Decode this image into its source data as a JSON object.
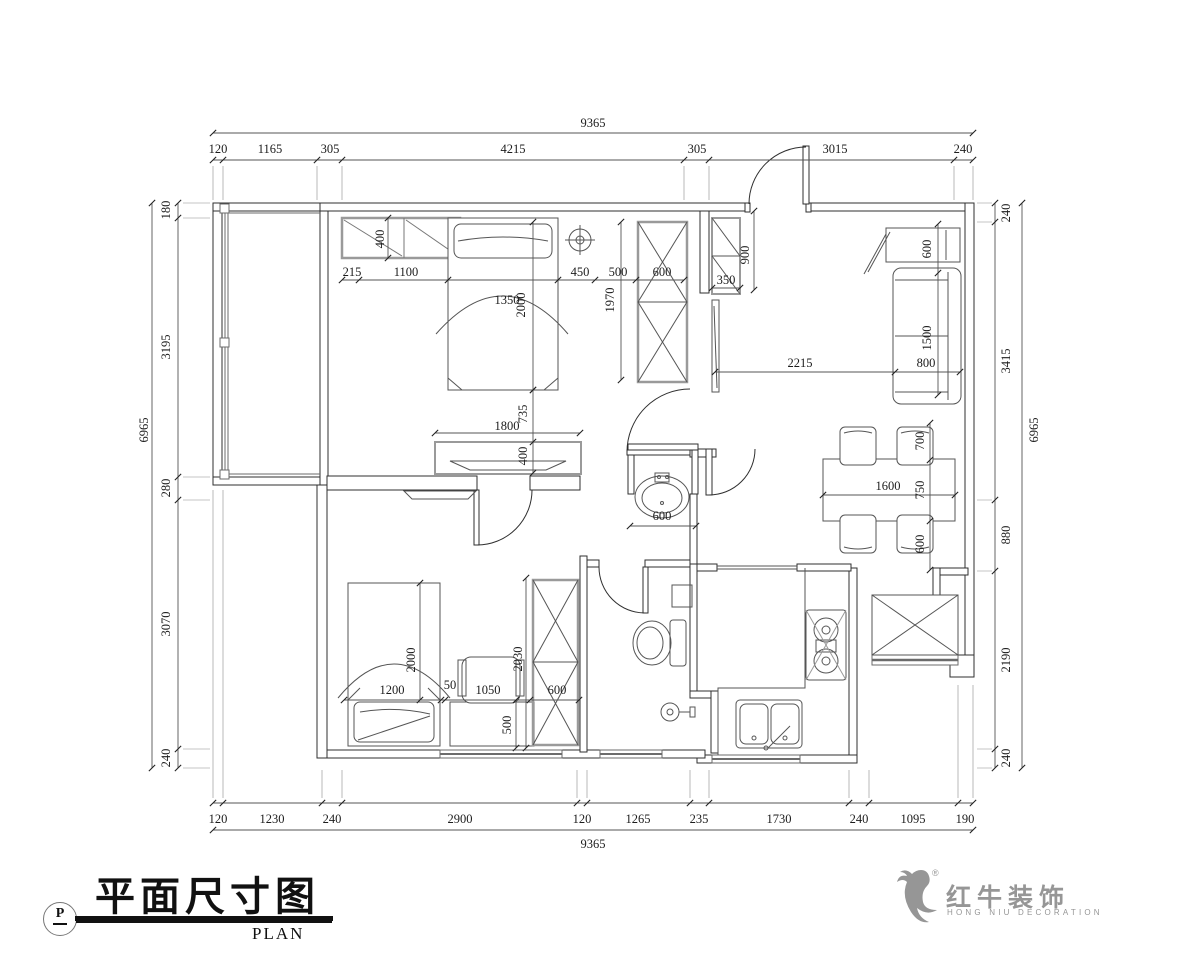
{
  "title_block": {
    "symbol": "P",
    "title_cn": "平面尺寸图",
    "title_en": "PLAN"
  },
  "logo": {
    "registered": "®",
    "brand_cn": "红牛装饰",
    "brand_en": "HONG NIU DECORATION",
    "color": "#969696"
  },
  "drawing": {
    "type": "floor-plan-dimension-drawing",
    "dim_color": "#1c1c1c",
    "overall_width_mm": 9365,
    "overall_height_mm": 6965,
    "labels": [
      {
        "t": "9365",
        "x": 593,
        "y": 124
      },
      {
        "t": "120",
        "x": 218,
        "y": 150
      },
      {
        "t": "1165",
        "x": 270,
        "y": 150
      },
      {
        "t": "305",
        "x": 330,
        "y": 150
      },
      {
        "t": "4215",
        "x": 513,
        "y": 150
      },
      {
        "t": "305",
        "x": 697,
        "y": 150
      },
      {
        "t": "3015",
        "x": 835,
        "y": 150
      },
      {
        "t": "240",
        "x": 963,
        "y": 150
      },
      {
        "t": "120",
        "x": 218,
        "y": 820
      },
      {
        "t": "1230",
        "x": 272,
        "y": 820
      },
      {
        "t": "240",
        "x": 332,
        "y": 820
      },
      {
        "t": "2900",
        "x": 460,
        "y": 820
      },
      {
        "t": "120",
        "x": 582,
        "y": 820
      },
      {
        "t": "1265",
        "x": 638,
        "y": 820
      },
      {
        "t": "235",
        "x": 699,
        "y": 820
      },
      {
        "t": "1730",
        "x": 779,
        "y": 820
      },
      {
        "t": "240",
        "x": 859,
        "y": 820
      },
      {
        "t": "1095",
        "x": 913,
        "y": 820
      },
      {
        "t": "190",
        "x": 965,
        "y": 820
      },
      {
        "t": "9365",
        "x": 593,
        "y": 845
      },
      {
        "t": "180",
        "x": 167,
        "y": 210,
        "r": -90
      },
      {
        "t": "3195",
        "x": 167,
        "y": 347,
        "r": -90
      },
      {
        "t": "280",
        "x": 167,
        "y": 488,
        "r": -90
      },
      {
        "t": "3070",
        "x": 167,
        "y": 624,
        "r": -90
      },
      {
        "t": "240",
        "x": 167,
        "y": 758,
        "r": -90
      },
      {
        "t": "6965",
        "x": 145,
        "y": 430,
        "r": -90
      },
      {
        "t": "240",
        "x": 1007,
        "y": 213,
        "r": -90
      },
      {
        "t": "3415",
        "x": 1007,
        "y": 361,
        "r": -90
      },
      {
        "t": "880",
        "x": 1007,
        "y": 535,
        "r": -90
      },
      {
        "t": "2190",
        "x": 1007,
        "y": 660,
        "r": -90
      },
      {
        "t": "240",
        "x": 1007,
        "y": 758,
        "r": -90
      },
      {
        "t": "6965",
        "x": 1035,
        "y": 430,
        "r": -90
      },
      {
        "t": "400",
        "x": 381,
        "y": 239,
        "r": -90
      },
      {
        "t": "215",
        "x": 352,
        "y": 273
      },
      {
        "t": "1100",
        "x": 406,
        "y": 273
      },
      {
        "t": "1350",
        "x": 507,
        "y": 301
      },
      {
        "t": "2000",
        "x": 522,
        "y": 305,
        "r": -90
      },
      {
        "t": "450",
        "x": 580,
        "y": 273
      },
      {
        "t": "500",
        "x": 618,
        "y": 273
      },
      {
        "t": "600",
        "x": 662,
        "y": 273
      },
      {
        "t": "1970",
        "x": 611,
        "y": 300,
        "r": -90
      },
      {
        "t": "350",
        "x": 726,
        "y": 281
      },
      {
        "t": "900",
        "x": 746,
        "y": 255,
        "r": -90
      },
      {
        "t": "600",
        "x": 928,
        "y": 249,
        "r": -90
      },
      {
        "t": "2215",
        "x": 800,
        "y": 364
      },
      {
        "t": "800",
        "x": 926,
        "y": 364
      },
      {
        "t": "1500",
        "x": 928,
        "y": 338,
        "r": -90
      },
      {
        "t": "700",
        "x": 921,
        "y": 441,
        "r": -90
      },
      {
        "t": "1600",
        "x": 888,
        "y": 487
      },
      {
        "t": "750",
        "x": 921,
        "y": 490,
        "r": -90
      },
      {
        "t": "600",
        "x": 921,
        "y": 544,
        "r": -90
      },
      {
        "t": "1800",
        "x": 507,
        "y": 427
      },
      {
        "t": "735",
        "x": 524,
        "y": 414,
        "r": -90
      },
      {
        "t": "400",
        "x": 524,
        "y": 456,
        "r": -90
      },
      {
        "t": "600",
        "x": 662,
        "y": 517
      },
      {
        "t": "1200",
        "x": 392,
        "y": 691
      },
      {
        "t": "2000",
        "x": 412,
        "y": 660,
        "r": -90
      },
      {
        "t": "50",
        "x": 450,
        "y": 686
      },
      {
        "t": "1050",
        "x": 488,
        "y": 691
      },
      {
        "t": "500",
        "x": 508,
        "y": 725,
        "r": -90
      },
      {
        "t": "2030",
        "x": 519,
        "y": 659,
        "r": -90
      },
      {
        "t": "600",
        "x": 557,
        "y": 691
      }
    ]
  }
}
